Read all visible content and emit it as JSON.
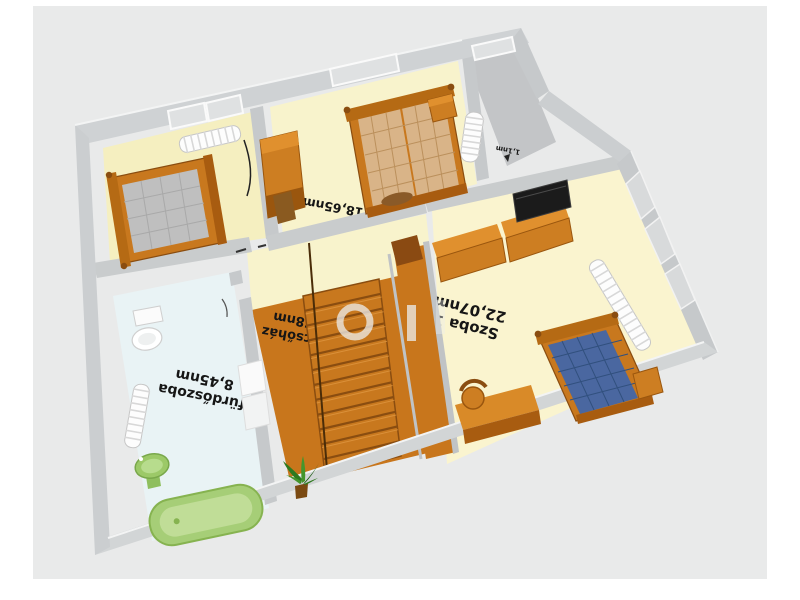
{
  "rooms": {
    "szoba1": {
      "name": "Szoba 1",
      "area": "22,07nm"
    },
    "szoba2": {
      "name": "",
      "area": "18,65nm"
    },
    "furdoszoba": {
      "name": "fürdőszoba",
      "area": "8,45nm"
    },
    "lepcsohaz": {
      "name": "lépcsőház",
      "area": "5,78nm"
    },
    "folyoso": {
      "name": "",
      "area": "1,1nm"
    }
  },
  "watermark": {
    "letters": "GI"
  },
  "colors": {
    "background": "#e9eaea",
    "floor_cream": "#f7f2c8",
    "floor_bath": "#e9f3f5",
    "floor_landing": "#c8761c",
    "wall": "#cfd2d4",
    "furniture_orange": "#cd7e22",
    "mattress_tan": "#d9b488",
    "mattress_gray": "#bcbcbc",
    "mattress_blue": "#4a67a0",
    "fixture_green": "#a6ce77",
    "tv_black": "#1b1b1b"
  }
}
